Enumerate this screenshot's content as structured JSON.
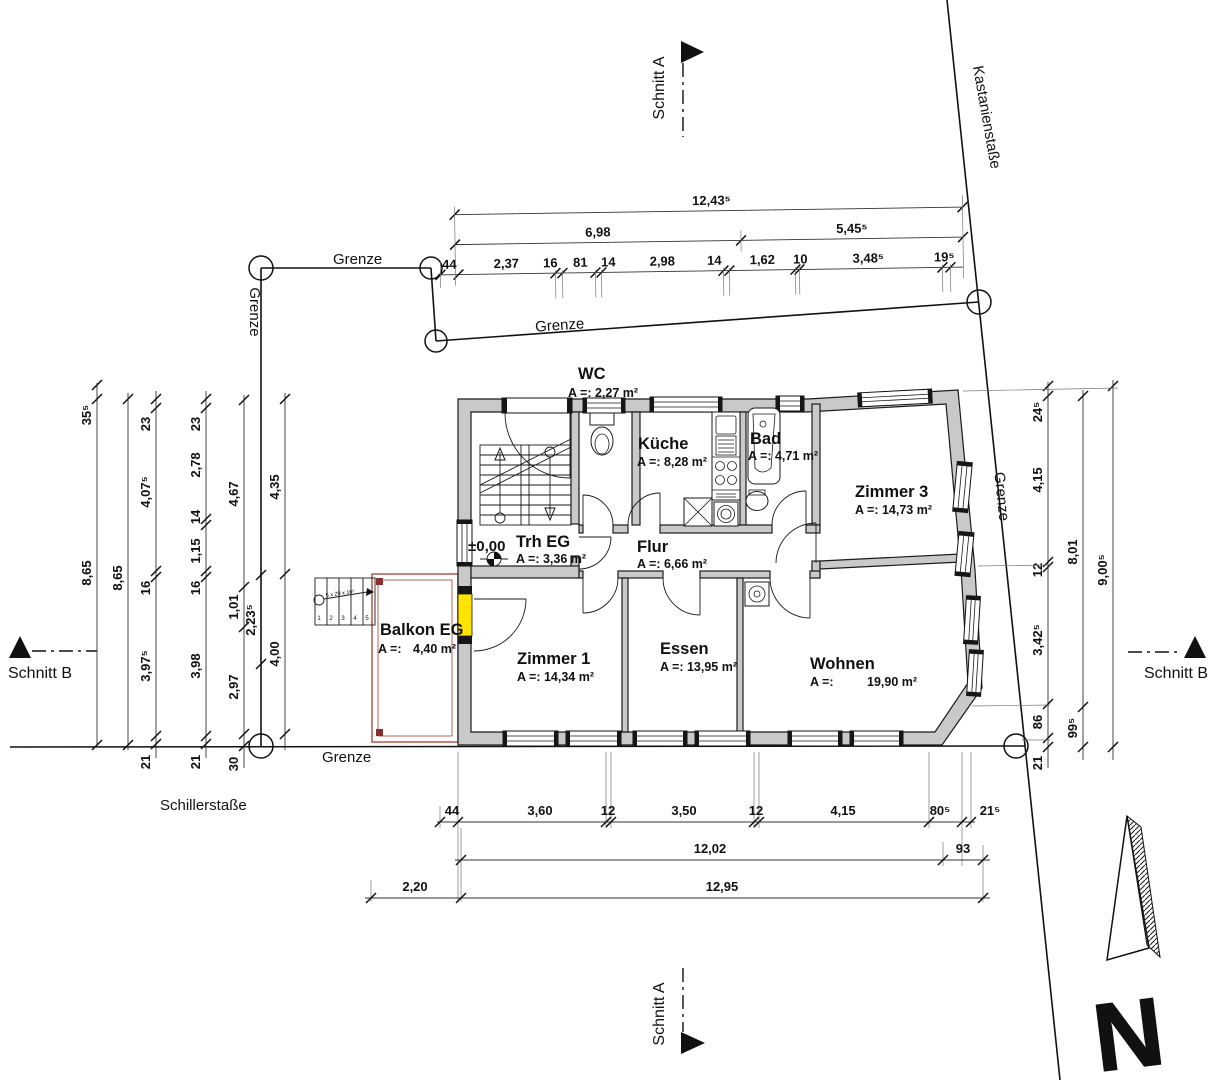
{
  "streets": {
    "top_right": "Kastanienstaße",
    "bottom": "Schillerstaße"
  },
  "boundary": {
    "label": "Grenze"
  },
  "sections": {
    "a": "Schnitt A",
    "b": "Schnitt B"
  },
  "north": {
    "letter": "N"
  },
  "level": {
    "value": "±0,00"
  },
  "rooms": {
    "wc": {
      "name": "WC",
      "area": "A =: 2,27 m²"
    },
    "kueche": {
      "name": "Küche",
      "area": "A =: 8,28 m²"
    },
    "bad": {
      "name": "Bad",
      "area": "A =: 4,71 m²"
    },
    "zimmer3": {
      "name": "Zimmer 3",
      "area": "A =: 14,73 m²"
    },
    "trh": {
      "name": "Trh EG",
      "area": "A =: 3,36 m²"
    },
    "flur": {
      "name": "Flur",
      "area": "A =: 6,66 m²"
    },
    "balkon": {
      "name": "Balkon EG",
      "area_label": "A =:",
      "area_value": "4,40 m²"
    },
    "zimmer1": {
      "name": "Zimmer 1",
      "area": "A =: 14,34 m²"
    },
    "essen": {
      "name": "Essen",
      "area": "A =: 13,95 m²"
    },
    "wohnen": {
      "name": "Wohnen",
      "area_label": "A =:",
      "area_value": "19,90 m²"
    }
  },
  "stairs": {
    "note": "5 x 29 x 16⁵",
    "steps": [
      "1",
      "2",
      "3",
      "4",
      "5"
    ]
  },
  "dims": {
    "top": {
      "total": "12,43⁵",
      "mid": [
        "6,98",
        "5,45⁵"
      ],
      "detail": [
        "44",
        "2,37",
        "16",
        "81",
        "14",
        "2,98",
        "14",
        "1,62",
        "10",
        "3,48⁵",
        "19⁵"
      ]
    },
    "left": {
      "outer": [
        "35⁵",
        "8,65"
      ],
      "total": "8,65",
      "chain1": [
        "23",
        "4,07⁵",
        "16",
        "3,97⁵",
        "21"
      ],
      "chain2": [
        "23",
        "2,78",
        "14",
        "1,15",
        "16",
        "3,98",
        "21"
      ],
      "chain3": [
        "4,67",
        "1,01",
        "2,97",
        "30"
      ],
      "grenze_seg": "2,23⁵",
      "chain4": [
        "4,35",
        "4,00"
      ]
    },
    "right": {
      "chain": [
        "24⁵",
        "4,15",
        "12",
        "3,42⁵",
        "86",
        "21"
      ],
      "mid": [
        "8,01",
        "99⁵"
      ],
      "total": "9,00⁵"
    },
    "bottom": {
      "detail": [
        "44",
        "3,60",
        "12",
        "3,50",
        "12",
        "4,15",
        "80⁵",
        "21⁵"
      ],
      "mid": [
        "12,02",
        "93"
      ],
      "total": [
        "2,20",
        "12,95"
      ]
    }
  },
  "colors": {
    "wall": "#c9c9c9",
    "highlight_door": "#ffe400",
    "balcony_border": "#b4645a"
  }
}
